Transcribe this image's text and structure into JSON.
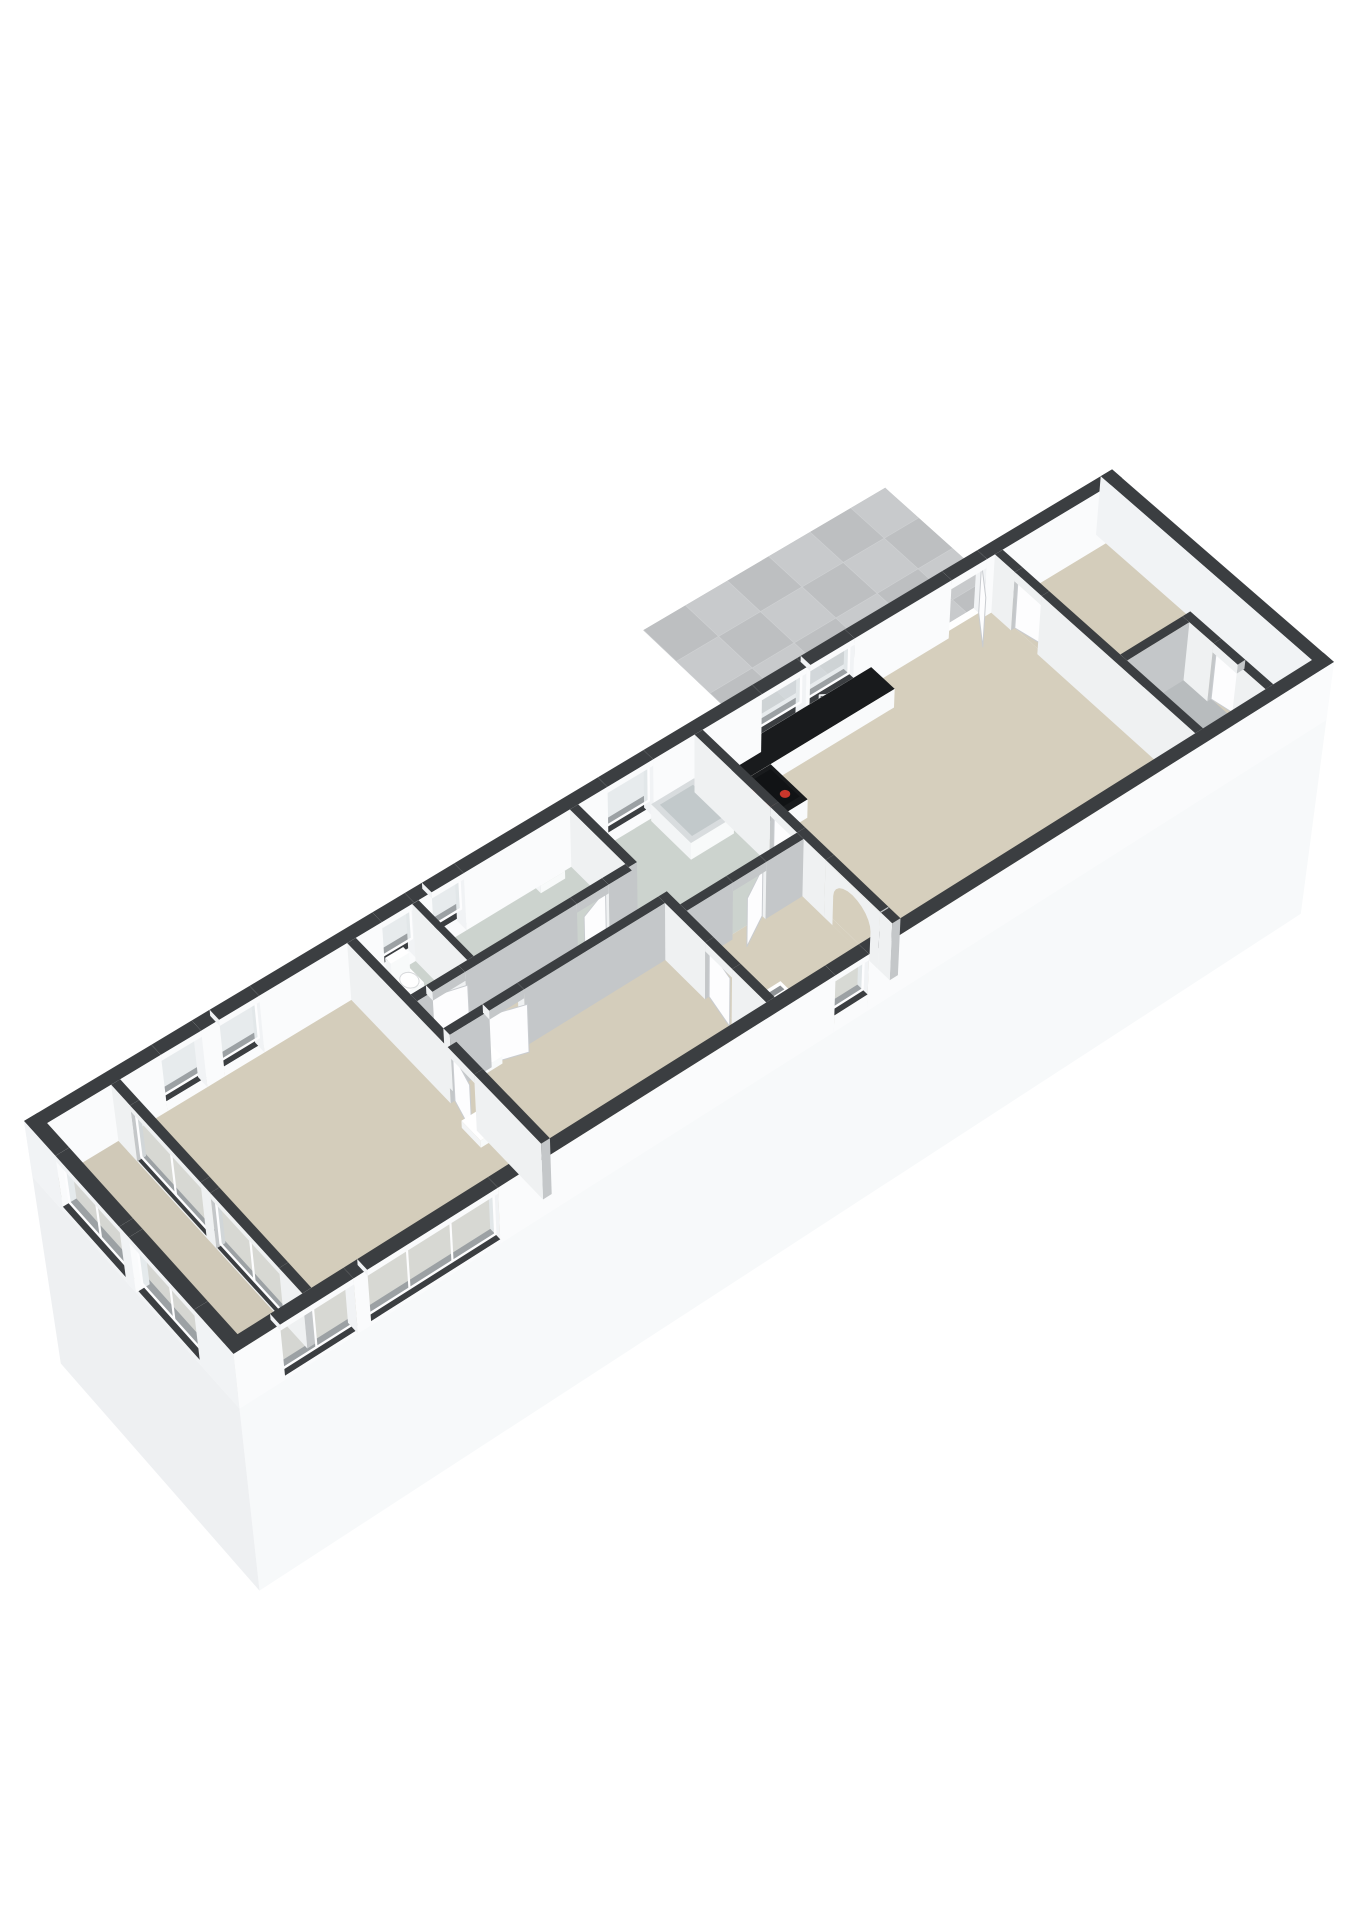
{
  "meta": {
    "view": "3d-dollhouse-floorplan",
    "background": "#ffffff"
  },
  "colors": {
    "background": "#ffffff",
    "cap": "#3b3e41",
    "glass": "#d8dee2",
    "accent_red": "#cb372c",
    "terrace_base": "#c0c2c4",
    "door_leaf": "#fdfdfe",
    "door_edge": "#c9ccd0"
  },
  "palettes": {
    "exterior": {
      "top": "#3b3e41",
      "nL": "#f1f3f5",
      "pL": "#e6e8ea",
      "nW": "#eef0f2",
      "pW": "#fafbfc"
    },
    "interior": {
      "top": "#3b3e41",
      "nL": "#eff1f2",
      "pL": "#d4d7d9",
      "nW": "#c9ccce",
      "pW": "#c4c7c9"
    },
    "white": {
      "top": "#ffffff",
      "nL": "#f3f5f6",
      "pL": "#e4e6e8",
      "nW": "#dcdfe1",
      "pW": "#f8fafa"
    },
    "counter": {
      "top": "#191b1d",
      "nL": "#f4f5f6",
      "pL": "#e8eaeb",
      "nW": "#eceeef",
      "pW": "#f9fafb"
    },
    "tub": {
      "top": "#d8dcde",
      "nL": "#f3f5f6",
      "pL": "#e4e6e8",
      "nW": "#dcdfe1",
      "pW": "#f8fafa"
    }
  },
  "camera": {
    "position": [
      -29,
      56,
      84
    ],
    "target": [
      13,
      3,
      0
    ],
    "fit": [
      24,
      358,
      1310,
      1344
    ]
  },
  "building": {
    "wall_height": 1.7,
    "skirt_depth": -6,
    "floors": [
      {
        "name": "loggia",
        "rect": [
          0.15,
          0.15,
          1.8,
          6.35
        ],
        "color": "#d0c9b8"
      },
      {
        "name": "bedroom-1",
        "rect": [
          1.8,
          0.15,
          7.1,
          6.35
        ],
        "color": "#d4cdbb"
      },
      {
        "name": "wc",
        "rect": [
          7.1,
          0.15,
          8.58,
          2.1
        ],
        "color": "#ccd3ce"
      },
      {
        "name": "bathroom-1",
        "rect": [
          8.58,
          0.15,
          12.3,
          2.1
        ],
        "color": "#ccd3ce"
      },
      {
        "name": "corridor",
        "rect": [
          7.1,
          2.1,
          12.3,
          3.1
        ],
        "color": "#d6cfbd"
      },
      {
        "name": "bedroom-2",
        "rect": [
          7.1,
          3.1,
          12.3,
          6.35
        ],
        "color": "#d4cdbb"
      },
      {
        "name": "bathroom-2",
        "rect": [
          12.3,
          0.15,
          15.3,
          3.5
        ],
        "color": "#ccd3ce"
      },
      {
        "name": "hallway",
        "rect": [
          12.3,
          3.5,
          15.3,
          6.35
        ],
        "color": "#d6cfbd"
      },
      {
        "name": "living-kitchen",
        "rect": [
          15.3,
          0.15,
          22.8,
          6.35
        ],
        "color": "#d6cfbd"
      },
      {
        "name": "bedroom-3",
        "rect": [
          22.8,
          0.15,
          25.85,
          6.35
        ],
        "color": "#d4cdbb"
      },
      {
        "name": "storage",
        "rect": [
          22.8,
          3.9,
          24.6,
          6.35
        ],
        "color": "#b8bcbe"
      }
    ],
    "walls": [
      {
        "name": "north-facade",
        "rect": [
          0,
          0,
          26,
          0.3
        ],
        "palette": "exterior",
        "openings": [
          {
            "at": [
              2.8,
              3.7
            ],
            "type": "window",
            "sill": 0.3
          },
          {
            "at": [
              4.1,
              5.0
            ],
            "type": "window",
            "sill": 0.3
          },
          {
            "at": [
              7.8,
              8.55
            ],
            "type": "window",
            "sill": 0.5
          },
          {
            "at": [
              8.95,
              9.7
            ],
            "type": "window",
            "sill": 0.5
          },
          {
            "at": [
              13.1,
              14.2
            ],
            "type": "window",
            "sill": 0.35
          },
          {
            "at": [
              16.85,
              17.95
            ],
            "type": "window",
            "sill": 0.55
          },
          {
            "at": [
              18.05,
              19.15
            ],
            "type": "window",
            "sill": 0.55
          },
          {
            "at": [
              21.6,
              22.5
            ],
            "type": "door",
            "leaf": {
              "hinge": "hi",
              "side": 1,
              "deg": 55
            }
          }
        ]
      },
      {
        "name": "south-facade",
        "rect": [
          0,
          6.2,
          26,
          6.5
        ],
        "palette": "exterior",
        "openings": [
          {
            "at": [
              1.0,
              2.6
            ],
            "type": "window",
            "sill": 0.12
          },
          {
            "at": [
              2.9,
              5.8
            ],
            "type": "window",
            "sill": 0.12
          },
          {
            "at": [
              13.6,
              14.4
            ],
            "type": "window",
            "sill": 0.5
          }
        ]
      },
      {
        "name": "west-facade",
        "rect": [
          0,
          0,
          0.3,
          6.5
        ],
        "palette": "exterior",
        "openings": [
          {
            "at": [
              1.0,
              3.0
            ],
            "type": "window",
            "sill": 0.15
          },
          {
            "at": [
              3.3,
              5.3
            ],
            "type": "window",
            "sill": 0.15
          }
        ]
      },
      {
        "name": "east-facade",
        "rect": [
          25.7,
          0,
          26,
          6.5
        ],
        "palette": "exterior",
        "openings": []
      },
      {
        "name": "loggia-glazing",
        "rect": [
          1.7,
          0.3,
          1.9,
          6.2
        ],
        "openings": [
          {
            "at": [
              0.9,
              3.1
            ],
            "type": "window",
            "sill": 0.06
          },
          {
            "at": [
              3.4,
              5.5
            ],
            "type": "window",
            "sill": 0.06
          }
        ]
      },
      {
        "name": "bedroom1-partition",
        "rect": [
          7.0,
          0.3,
          7.2,
          6.2
        ],
        "openings": [
          {
            "at": [
              3.4,
              4.2
            ],
            "type": "door",
            "leaf": {
              "hinge": "lo",
              "side": -1,
              "deg": 14
            }
          }
        ]
      },
      {
        "name": "mid-partition",
        "rect": [
          12.2,
          0.3,
          12.4,
          6.2
        ],
        "openings": [
          {
            "at": [
              2.1,
              3.0
            ],
            "type": "open"
          },
          {
            "at": [
              4.4,
              5.2
            ],
            "type": "door",
            "leaf": {
              "hinge": "lo",
              "side": -1,
              "deg": 10
            }
          }
        ]
      },
      {
        "name": "living-partition",
        "rect": [
          15.2,
          0.3,
          15.4,
          6.2
        ],
        "openings": [
          {
            "at": [
              2.6,
              3.4
            ],
            "type": "door",
            "leaf": {
              "hinge": "lo",
              "side": 1,
              "deg": 12
            }
          },
          {
            "at": [
              4.5,
              5.6
            ],
            "type": "arch"
          }
        ]
      },
      {
        "name": "bedroom3-partition",
        "rect": [
          22.7,
          0.3,
          22.9,
          6.2
        ],
        "openings": [
          {
            "at": [
              0.9,
              1.7
            ],
            "type": "door",
            "leaf": {
              "hinge": "lo",
              "side": 1,
              "deg": 12
            }
          }
        ]
      },
      {
        "name": "bath-corridor-wall",
        "rect": [
          7.2,
          2.0,
          12.2,
          2.2
        ],
        "openings": [
          {
            "at": [
              7.55,
              8.3
            ],
            "type": "door",
            "leaf": {
              "hinge": "lo",
              "side": 1,
              "deg": 16
            }
          },
          {
            "at": [
              10.9,
              11.65
            ],
            "type": "door",
            "leaf": {
              "hinge": "hi",
              "side": 1,
              "deg": 20
            }
          }
        ]
      },
      {
        "name": "wc-bath-divider",
        "rect": [
          8.5,
          0.3,
          8.65,
          2.0
        ],
        "openings": []
      },
      {
        "name": "corridor-bedroom2-wall",
        "rect": [
          7.2,
          3.0,
          12.2,
          3.2
        ],
        "openings": [
          {
            "at": [
              8.1,
              8.9
            ],
            "type": "door",
            "leaf": {
              "hinge": "lo",
              "side": 1,
              "deg": 18
            }
          }
        ]
      },
      {
        "name": "bath2-hall-wall",
        "rect": [
          12.4,
          3.4,
          15.2,
          3.6
        ],
        "openings": [
          {
            "at": [
              13.5,
              14.3
            ],
            "type": "door",
            "leaf": {
              "hinge": "hi",
              "side": 1,
              "deg": 30
            }
          }
        ]
      },
      {
        "name": "storage-wall-long",
        "rect": [
          22.9,
          3.8,
          24.5,
          4.0
        ],
        "openings": []
      },
      {
        "name": "storage-wall-cross",
        "rect": [
          24.5,
          3.8,
          24.7,
          6.2
        ],
        "openings": [
          {
            "at": [
              4.7,
              5.4
            ],
            "type": "door",
            "leaf": {
              "hinge": "lo",
              "side": 1,
              "deg": 10
            }
          }
        ]
      }
    ],
    "skirts": [
      {
        "name": "skirt-south",
        "plane": "W",
        "at": 6.5,
        "range": [
          0,
          26
        ],
        "fill": "#f7f9fa"
      },
      {
        "name": "skirt-west",
        "plane": "L",
        "at": 0,
        "range": [
          0,
          6.5
        ],
        "fill": "#eef0f2"
      }
    ],
    "terrace": {
      "name": "terrace",
      "poly": [
        [
          17,
          -0.45
        ],
        [
          20,
          -0.45
        ],
        [
          20,
          0
        ],
        [
          23.2,
          0
        ],
        [
          23.2,
          -3.6
        ],
        [
          17,
          -3.6
        ]
      ],
      "z": 0.02,
      "fill": "#c0c2c4",
      "tiles": {
        "origin": [
          17,
          -3.6
        ],
        "size": 1.06,
        "cols": 6,
        "rows": 4,
        "colors": [
          "#bdbfc1",
          "#c8cacc"
        ],
        "stroke": "#cfd1d3"
      }
    },
    "fixtures": [
      {
        "type": "box",
        "name": "toilet-tank",
        "rect": [
          7.72,
          0.45,
          8.14,
          0.63
        ],
        "z": [
          0.28,
          0.85
        ]
      },
      {
        "type": "box",
        "name": "toilet-bowl",
        "rect": [
          7.74,
          0.63,
          8.12,
          1.1
        ],
        "z": [
          0,
          0.44
        ]
      },
      {
        "type": "ellipse",
        "name": "toilet-seat",
        "c": [
          7.93,
          0.9
        ],
        "r": [
          0.17,
          0.2
        ],
        "z": 0.46,
        "fill": "#ffffff",
        "stroke": "#d8dadc"
      },
      {
        "type": "box",
        "name": "basin-bathroom1",
        "rect": [
          11.1,
          0.42,
          11.68,
          0.8
        ],
        "z": [
          0.52,
          0.74
        ]
      },
      {
        "type": "box",
        "name": "basin-bedroom2",
        "rect": [
          7.5,
          3.22,
          8.08,
          3.58
        ],
        "z": [
          0.52,
          0.74
        ]
      },
      {
        "type": "box",
        "name": "basin-bedroom1",
        "rect": [
          6.6,
          4.3,
          6.99,
          4.88
        ],
        "z": [
          0.52,
          0.74
        ]
      },
      {
        "type": "box",
        "name": "kitchen-counter",
        "rect": [
          15.6,
          0.3,
          19.6,
          1.02
        ],
        "z": [
          0,
          0.55
        ],
        "palette": "counter"
      },
      {
        "type": "box",
        "name": "kitchen-counter-stub",
        "rect": [
          15.6,
          1.02,
          16.5,
          2.15
        ],
        "z": [
          0,
          0.55
        ],
        "palette": "counter"
      },
      {
        "type": "quadtop",
        "name": "cooktop",
        "rect": [
          15.7,
          1.12,
          16.42,
          2.0
        ],
        "z": 0.555,
        "fill": "#111315"
      },
      {
        "type": "dots",
        "name": "cooktop-burners",
        "centers": [
          [
            15.88,
            1.36
          ],
          [
            16.24,
            1.36
          ],
          [
            15.88,
            1.78
          ],
          [
            16.24,
            1.78
          ]
        ],
        "r": 0.1,
        "z": 0.56,
        "fill": "#cb372c"
      },
      {
        "type": "ellipse",
        "name": "kitchen-sink",
        "c": [
          18.55,
          0.66
        ],
        "r": [
          0.3,
          0.24
        ],
        "z": 0.555,
        "fill": "#3a3e41"
      },
      {
        "type": "ellipse",
        "name": "kitchen-sink-inner",
        "c": [
          18.55,
          0.66
        ],
        "r": [
          0.21,
          0.16
        ],
        "z": 0.558,
        "fill": "#212427"
      },
      {
        "type": "line",
        "name": "sink-faucet",
        "pts": [
          [
            18.2,
            0.42,
            0.555
          ],
          [
            18.2,
            0.42,
            0.82
          ],
          [
            18.38,
            0.55,
            0.82
          ]
        ],
        "stroke": "#e6e8ea",
        "sw": 2
      },
      {
        "type": "wallpanel",
        "name": "washing-machine",
        "plane": "W",
        "at": 0.315,
        "range": [
          15.95,
          16.68
        ],
        "z": [
          0.58,
          1.42
        ],
        "fill": "#131518"
      },
      {
        "type": "wallcircle",
        "name": "washing-machine-door",
        "c": [
          16.31,
          1.0
        ],
        "at": 0.32,
        "r": 0.27,
        "fill": "#24272a",
        "stroke": "#989da1",
        "sw": 2.6
      },
      {
        "type": "wallcircle",
        "name": "washing-machine-door-inner",
        "c": [
          16.31,
          1.0
        ],
        "at": 0.325,
        "r": 0.13,
        "fill": "#41454a"
      },
      {
        "type": "box",
        "name": "boiler",
        "rect": [
          12.55,
          5.52,
          13.1,
          6.06
        ],
        "z": [
          0,
          0.95
        ]
      },
      {
        "type": "wallpanel",
        "name": "boiler-stripe",
        "plane": "L",
        "at": 12.54,
        "range": [
          5.58,
          6.0
        ],
        "z": [
          0.7,
          0.8
        ],
        "fill": "#cb372c"
      },
      {
        "type": "quadtop",
        "name": "boiler-vent",
        "rect": [
          12.62,
          5.6,
          13.03,
          5.72
        ],
        "z": 0.955,
        "fill": "#8f9396"
      },
      {
        "type": "box",
        "name": "bathtub",
        "rect": [
          14.1,
          0.35,
          15.15,
          1.58
        ],
        "z": [
          0,
          0.5
        ],
        "palette": "tub"
      },
      {
        "type": "quadtop",
        "name": "bathtub-well",
        "rect": [
          14.22,
          0.47,
          15.03,
          1.46
        ],
        "z": 0.505,
        "fill": "#c2c9cb"
      },
      {
        "type": "dots",
        "name": "bathtub-faucet",
        "centers": [
          [
            14.95,
            0.55
          ]
        ],
        "r": 0.05,
        "z": 0.51,
        "fill": "#8a8f93"
      }
    ]
  }
}
